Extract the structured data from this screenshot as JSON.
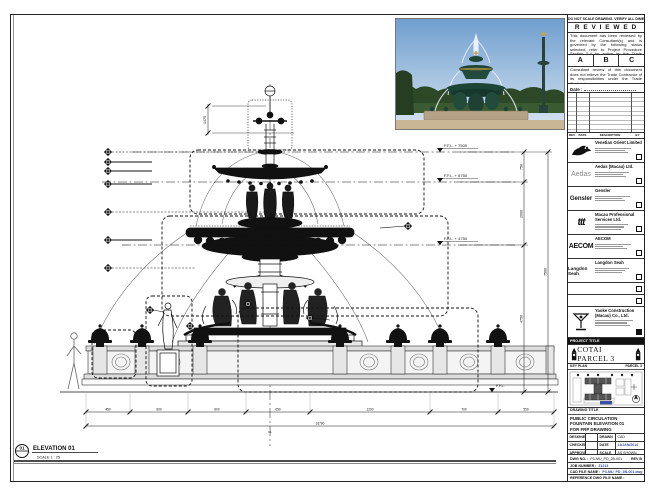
{
  "sheet": {
    "bg": "#ffffff",
    "ink": "#111111",
    "accent_blue": "#3b4ea0"
  },
  "strip_note": "DO NOT SCALE DRAWING. VERIFY ALL DIMENSIONS ON SITE.",
  "stamp": {
    "title": "R E V I E W E D",
    "para1": "This document has been reviewed by the relevant Consultant(s) and is governed by the following status selected, refer to Project Procedure Section 5.4 for action by the Trade Contractor.",
    "options": [
      "A",
      "B",
      "C"
    ],
    "para2": "Consultant review of this document does not relieve the Trade Contractor of its responsibilities under the Trade Contract.",
    "date_label": "Date :"
  },
  "revision_table": {
    "headers": [
      "REV",
      "DATE",
      "DESCRIPTION",
      "BY"
    ]
  },
  "consultants": [
    {
      "name": "Venetian Orient Limited",
      "logo_text": ""
    },
    {
      "name": "Aedas (Macau) Ltd.",
      "logo_text": "Aedas"
    },
    {
      "name": "Gensler",
      "logo_text": "Gensler"
    },
    {
      "name": "Macau Professional Services Ltd.",
      "logo_text": "ttt"
    },
    {
      "name": "AECOM",
      "logo_text": "AECOM"
    },
    {
      "name": "Langdon Seah",
      "logo_text": "Langdon Seah"
    }
  ],
  "contractor": {
    "name": "Yaoke Construction (Macau) Co., Ltd."
  },
  "project": {
    "label": "PROJECT TITLE",
    "title": "COTAI PARCEL 3"
  },
  "key_plan": {
    "label": "KEY PLAN",
    "parcel": "PARCEL 3"
  },
  "title_block": {
    "drawing_title_label": "DRAWING TITLE",
    "title_line1": "PUBLIC CIRCULATION",
    "title_line2": "FOUNTAIN ELEVATION 01",
    "title_line3": "FOR FRP DRAWING",
    "fields": {
      "designed_label": "DESIGNED",
      "designed": "",
      "drawn_label": "DRAWN",
      "drawn": "CAD",
      "checked_label": "CHECKED",
      "checked": "-",
      "date_label": "DATE",
      "date": "13/JAN/2014",
      "approved_label": "APPROVED",
      "approved": "-",
      "scale_label": "SCALE",
      "scale": "AS SHOWN"
    },
    "dwg_no_label": "DWG NO. :",
    "dwg_no": "P3-MU_PD_2B-001",
    "rev": "REV B",
    "job_label": "JOB NUMBER :",
    "job": "31213",
    "cad_label": "CAD FILE NAME :",
    "cad": "P3-MU_PD_2B-001.dwg",
    "ref_label": "REFERENCE DWG FILE NAME :"
  },
  "drawing": {
    "view_number": "01",
    "view_title": "ELEVATION 01",
    "view_scale": "SCALE 1 : 25",
    "levels": {
      "l1": "F.F.L. + 7500",
      "l2": "F.F.L. + 6750",
      "l3": "F.F.L. + 4750",
      "l0": "F.F.L."
    },
    "vdims": {
      "v1": "750",
      "v2": "2000",
      "v3": "4750",
      "vtotal": "7500"
    },
    "top_dim": "1475",
    "bottom_dims": [
      "450",
      "600",
      "600",
      "650",
      "1200",
      "700",
      "550"
    ],
    "bottom_total": "16700",
    "cl_label": "CL"
  }
}
